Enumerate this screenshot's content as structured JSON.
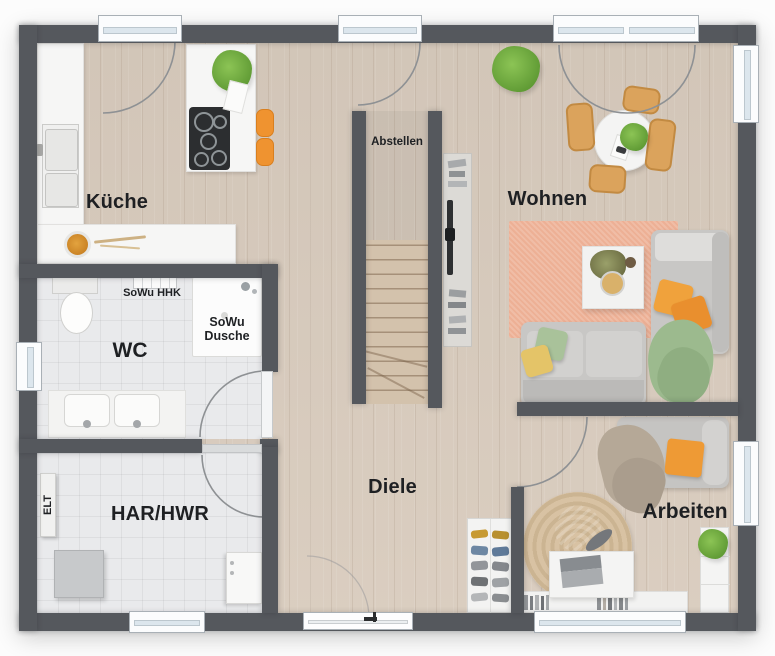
{
  "rooms": {
    "kueche": {
      "label": "Küche"
    },
    "abstellen": {
      "label": "Abstellen"
    },
    "wohnen": {
      "label": "Wohnen"
    },
    "wc": {
      "label": "WC"
    },
    "diele": {
      "label": "Diele"
    },
    "har_hwr": {
      "label": "HAR/HWR"
    },
    "arbeiten": {
      "label": "Arbeiten"
    }
  },
  "annotations": {
    "sowu_hhk": "SoWu HHK",
    "sowu_dusche": {
      "line1": "SoWu",
      "line2": "Dusche"
    },
    "elt": "ELT"
  },
  "colors": {
    "wall": "#55585d",
    "wood_floor": "#d9ccbe",
    "tile_floor": "#e9eaec",
    "counter_white": "#f6f6f5",
    "accent_orange": "#ef9733",
    "rug_orange": "#edb095",
    "sofa_gray": "#c8c7c5",
    "chair_tan": "#d7a05a",
    "plant_green": "#76ad45",
    "jute_rug": "#d6c09f"
  }
}
